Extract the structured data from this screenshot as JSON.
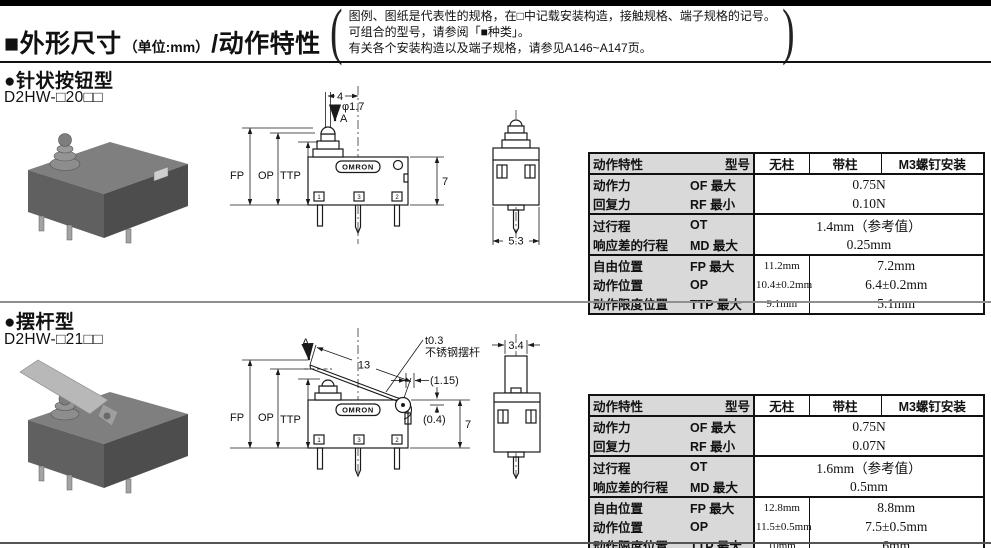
{
  "header": {
    "title_main": "■外形尺寸",
    "title_unit": "（单位:mm）",
    "title_suffix": "/动作特性",
    "note_paren_open": "(",
    "note_paren_close": ")",
    "note_lines": [
      "图例、图纸是代表性的规格，在□中记载安装构造，接触规格、端子规格的记号。",
      "可组合的型号，请参阅「■种类」。",
      "有关各个安装构造以及端子规格，请参见A146~A147页。"
    ]
  },
  "sections": [
    {
      "title": "●针状按钮型",
      "model": "D2HW-□20□□"
    },
    {
      "title": "●摆杆型",
      "model": "D2HW-□21□□"
    }
  ],
  "drawings": {
    "logo": "OMRON",
    "terminals": [
      "1",
      "3",
      "2"
    ],
    "pin_type": {
      "dim_width": "4",
      "dim_dia": "φ1.7",
      "arrow_label": "A",
      "fp": "FP",
      "op": "OP",
      "ttp": "TTP",
      "dim_height": "7",
      "side_width": "5.3"
    },
    "lever_type": {
      "arrow_label": "A",
      "lever_length": "13",
      "lever_note_line1": "t0.3",
      "lever_note_line2": "不锈钢摆杆",
      "dim_offset": "(1.15)",
      "dim_pivot": "(0.4)",
      "fp": "FP",
      "op": "OP",
      "ttp": "TTP",
      "dim_height": "7",
      "side_width": "3.4"
    }
  },
  "colors": {
    "table_header_bg": "#d9d9d9",
    "rule_dark": "#111111",
    "rule_gray": "#8f8f8f"
  },
  "tables": [
    {
      "header": {
        "characteristic": "动作特性",
        "model": "型号",
        "nopin": "无柱",
        "pin": "带柱",
        "m3": "M3螺钉安装"
      },
      "groups": [
        {
          "rows": [
            {
              "label": "动作力",
              "code": "OF 最大",
              "value": "0.75N"
            },
            {
              "label": "回复力",
              "code": "RF 最小",
              "value": "0.10N"
            }
          ]
        },
        {
          "rows": [
            {
              "label": "过行程",
              "code": "OT",
              "value": "1.4mm（参考值）"
            },
            {
              "label": "响应差的行程",
              "code": "MD 最大",
              "value": "0.25mm"
            }
          ]
        },
        {
          "rows": [
            {
              "label": "自由位置",
              "code": "FP 最大",
              "v1": "11.2mm",
              "v2": "7.2mm"
            },
            {
              "label": "动作位置",
              "code": "OP",
              "v1": "10.4±0.2mm",
              "v2": "6.4±0.2mm"
            },
            {
              "label": "动作限度位置",
              "code": "TTP 最大",
              "v1": "9.1mm",
              "v2": "5.1mm"
            }
          ]
        }
      ]
    },
    {
      "header": {
        "characteristic": "动作特性",
        "model": "型号",
        "nopin": "无柱",
        "pin": "带柱",
        "m3": "M3螺钉安装"
      },
      "groups": [
        {
          "rows": [
            {
              "label": "动作力",
              "code": "OF 最大",
              "value": "0.75N"
            },
            {
              "label": "回复力",
              "code": "RF 最小",
              "value": "0.07N"
            }
          ]
        },
        {
          "rows": [
            {
              "label": "过行程",
              "code": "OT",
              "value": "1.6mm（参考值）"
            },
            {
              "label": "响应差的行程",
              "code": "MD 最大",
              "value": "0.5mm"
            }
          ]
        },
        {
          "rows": [
            {
              "label": "自由位置",
              "code": "FP 最大",
              "v1": "12.8mm",
              "v2": "8.8mm"
            },
            {
              "label": "动作位置",
              "code": "OP",
              "v1": "11.5±0.5mm",
              "v2": "7.5±0.5mm"
            },
            {
              "label": "动作限度位置",
              "code": "TTP 最大",
              "v1": "10mm",
              "v2": "6mm"
            }
          ]
        }
      ]
    }
  ]
}
